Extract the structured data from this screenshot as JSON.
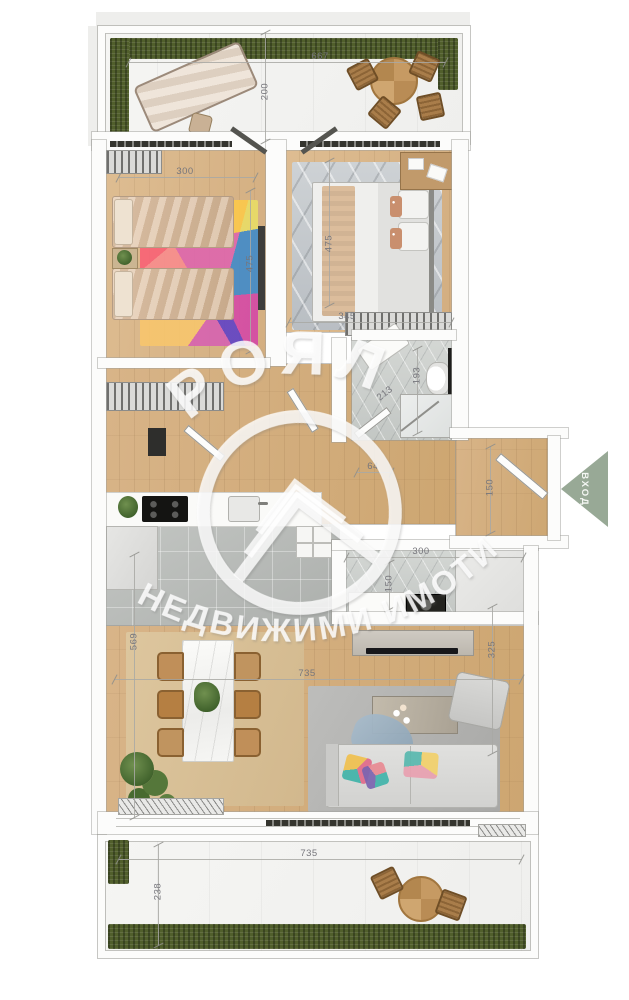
{
  "watermark": {
    "title": "РОЯЛ",
    "subtitle": "НЕДВИЖИМИ ИМОТИ"
  },
  "entrance": {
    "label": "ВХОД",
    "arrow_color": "#98a996"
  },
  "dims": {
    "terrace_top_w": "667",
    "terrace_top_d": "200",
    "bed1_w": "300",
    "bed1_d": "475",
    "bed2_d": "475",
    "bed2_w": "345",
    "bath_d": "193",
    "bath_w": "213",
    "hall_w": "64",
    "entry_d": "150",
    "laundry_w": "300",
    "laundry_d": "150",
    "living_d": "569",
    "living_w": "735",
    "living_right_d": "325",
    "terrace_bottom_w": "735",
    "terrace_bottom_d": "238"
  },
  "colors": {
    "grass": "#515f2c",
    "wood_floor": "#d2ab7c",
    "tile_floor": "#b7bab7",
    "watermark_white": "#ffffff"
  }
}
